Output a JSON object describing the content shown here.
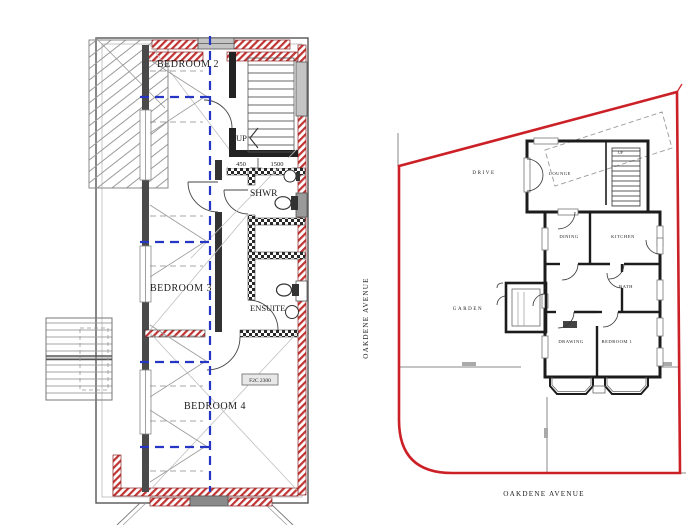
{
  "first_floor_plan": {
    "labels": {
      "bedroom2": "BEDROOM 2",
      "bedroom3": "BEDROOM 3",
      "bedroom4": "BEDROOM 4",
      "shower": "SHWR",
      "ensuite": "ENSUITE",
      "stairs_up": "UP"
    },
    "dimensions": {
      "landing_left": "450",
      "landing_right": "1500"
    },
    "note": "F2C 2300"
  },
  "site_plan": {
    "street_name_vertical": "OAKDENE AVENUE",
    "street_name_bottom": "OAKDENE AVENUE",
    "areas": {
      "drive": "DRIVE",
      "garden": "GARDEN"
    },
    "rooms": {
      "lounge": "LOUNGE",
      "dining": "DINING",
      "kitchen": "KITCHEN",
      "bath": "BATH",
      "drawing_room": "DRAWING",
      "bedroom1": "BEDROOM 1"
    },
    "stairs_up": "UP"
  },
  "colors": {
    "site_boundary_red": "#cc2027",
    "wall_hatch_red": "#c23434",
    "guide_blue": "#2636c4",
    "wall_dark": "#1c1c1c",
    "detail_gray": "#8a8a8a",
    "background": "#ffffff"
  }
}
